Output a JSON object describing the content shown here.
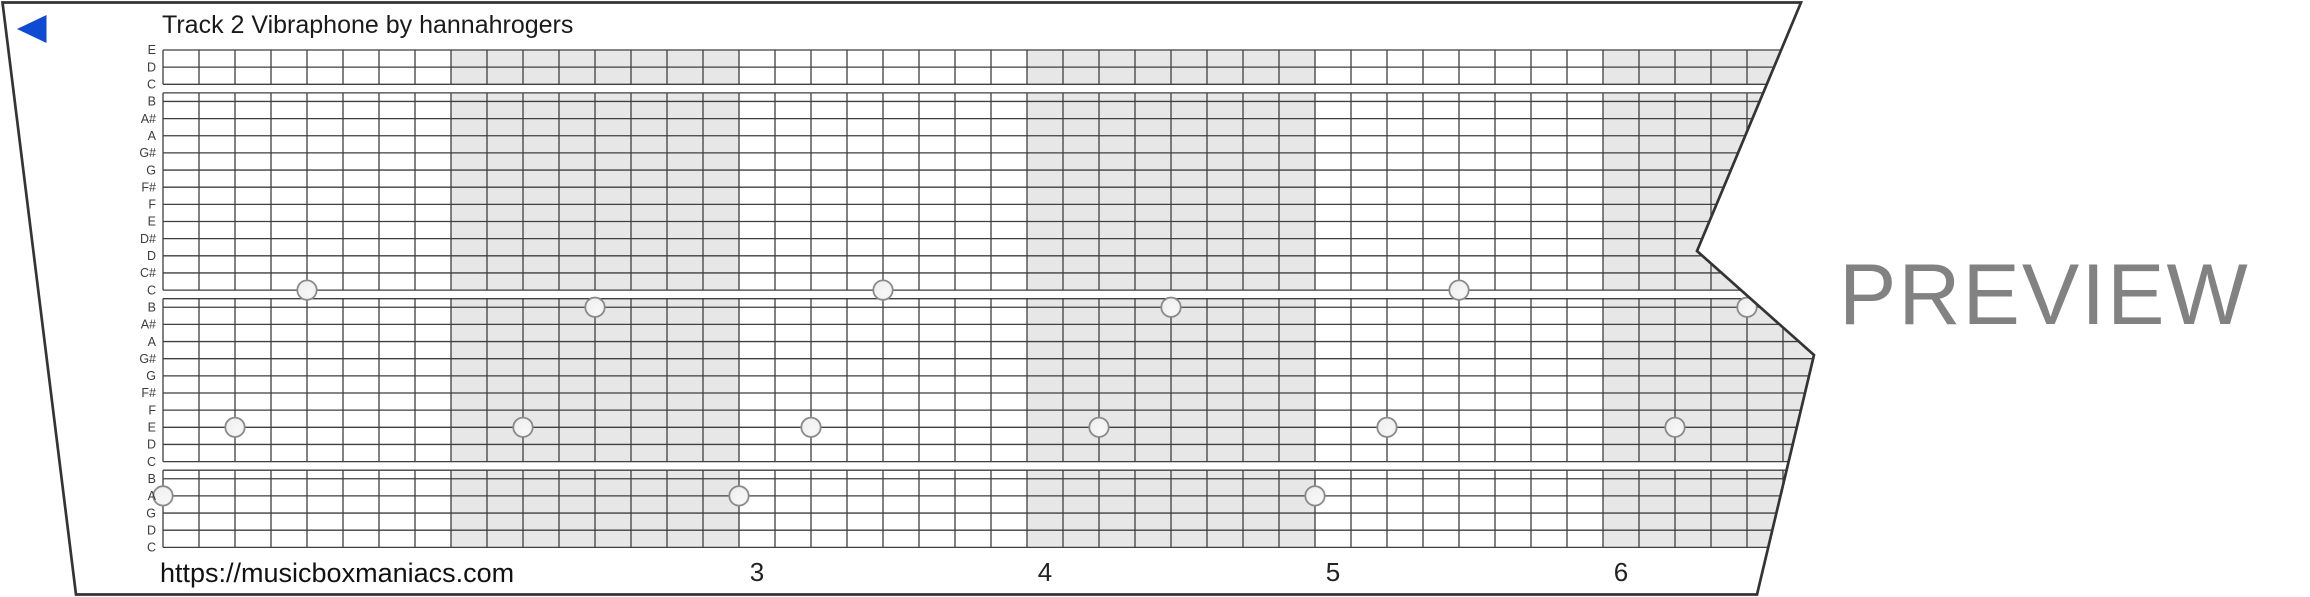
{
  "strip": {
    "title": "Track 2 Vibraphone by hannahrogers",
    "row_labels": [
      "E",
      "D",
      "C",
      "B",
      "A#",
      "A",
      "G#",
      "G",
      "F#",
      "F",
      "E",
      "D#",
      "D",
      "C#",
      "C",
      "B",
      "A#",
      "A",
      "G#",
      "G",
      "F#",
      "F",
      "E",
      "D",
      "C",
      "B",
      "A",
      "G",
      "D",
      "C"
    ],
    "octave_breaks_after": [
      2,
      14,
      24
    ],
    "shaded_measures": [
      2,
      4,
      6
    ],
    "measure_numbers": [
      "3",
      "4",
      "5",
      "6"
    ],
    "first_numbered_measure": 3,
    "notes": [
      {
        "cell": 0,
        "row": 26,
        "note": "A"
      },
      {
        "cell": 2,
        "row": 22,
        "note": "E"
      },
      {
        "cell": 4,
        "row": 14,
        "note": "C"
      },
      {
        "cell": 10,
        "row": 22,
        "note": "E"
      },
      {
        "cell": 12,
        "row": 15,
        "note": "B"
      },
      {
        "cell": 16,
        "row": 26,
        "note": "A"
      },
      {
        "cell": 18,
        "row": 22,
        "note": "E"
      },
      {
        "cell": 20,
        "row": 14,
        "note": "C"
      },
      {
        "cell": 26,
        "row": 22,
        "note": "E"
      },
      {
        "cell": 28,
        "row": 15,
        "note": "B"
      },
      {
        "cell": 32,
        "row": 26,
        "note": "A"
      },
      {
        "cell": 34,
        "row": 22,
        "note": "E"
      },
      {
        "cell": 36,
        "row": 14,
        "note": "C"
      },
      {
        "cell": 42,
        "row": 22,
        "note": "E"
      },
      {
        "cell": 44,
        "row": 15,
        "note": "B"
      }
    ]
  },
  "footer": {
    "url": "https://musicboxmaniacs.com"
  },
  "watermark": {
    "text": "PREVIEW"
  },
  "icons": {
    "rewind_triangle": "left-pointing-triangle"
  },
  "colors": {
    "accent_blue": "#0e4bd2",
    "grid_line": "#3f3f3f",
    "measure_shade": "#e7e7e7",
    "paper_outline": "#343434",
    "hole_fill": "#ededed",
    "hole_stroke": "#8a8a8a",
    "watermark_gray": "#828282",
    "label_gray": "#3c3c3c",
    "number_gray": "#222222"
  }
}
